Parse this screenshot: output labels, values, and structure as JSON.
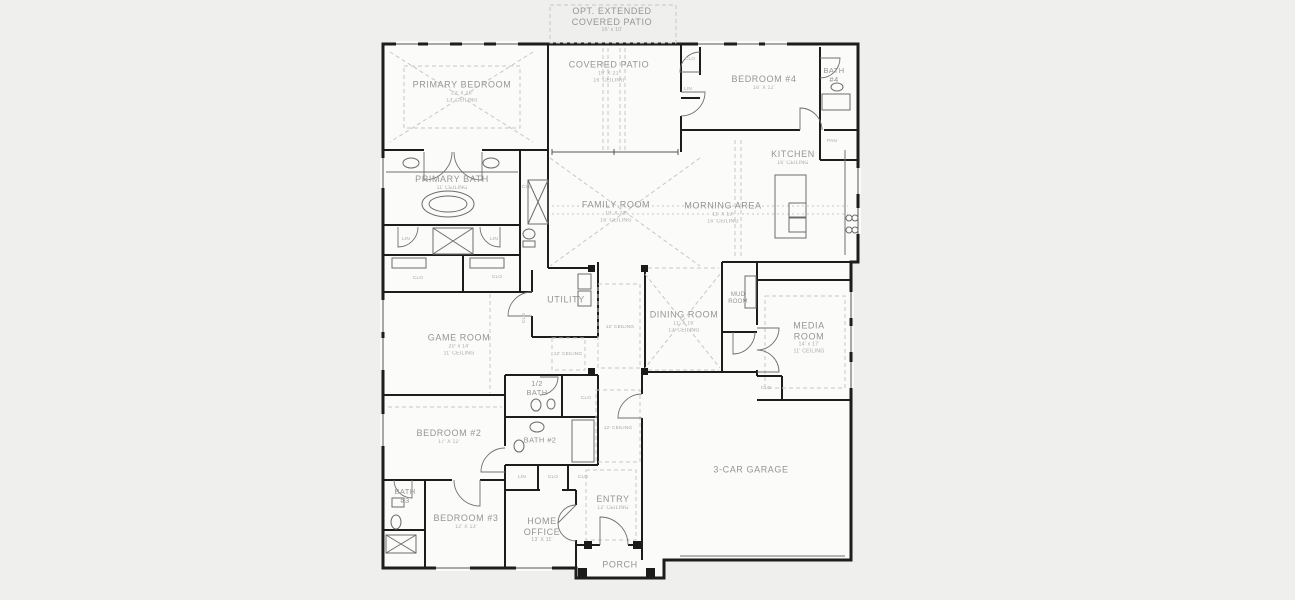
{
  "drawing_type": "residential floor plan",
  "colors": {
    "background": "#efefee",
    "paper": "#fbfbfa",
    "wall_ink": "#1d1d1d",
    "label_gray": "#959595",
    "dashed_gray": "#c7c7c7"
  },
  "rooms": [
    {
      "name": "OPT. EXTENDED COVERED PATIO",
      "dims": "16' x 10'",
      "ceiling": ""
    },
    {
      "name": "COVERED PATIO",
      "dims": "16' X 21'",
      "ceiling": "16' CEILING"
    },
    {
      "name": "PRIMARY BEDROOM",
      "dims": "22' X 16'",
      "ceiling": "13' CEILING"
    },
    {
      "name": "BEDROOM #4",
      "dims": "16' X 12'",
      "ceiling": ""
    },
    {
      "name": "BATH #4",
      "dims": "",
      "ceiling": ""
    },
    {
      "name": "KITCHEN",
      "dims": "",
      "ceiling": "16' CEILING"
    },
    {
      "name": "FAMILY ROOM",
      "dims": "19' X 21'",
      "ceiling": "16' CEILING"
    },
    {
      "name": "MORNING AREA",
      "dims": "11' X 13'",
      "ceiling": "16' CEILING"
    },
    {
      "name": "PRIMARY BATH",
      "dims": "",
      "ceiling": "11' CEILING"
    },
    {
      "name": "UTILITY",
      "dims": "",
      "ceiling": ""
    },
    {
      "name": "DINING ROOM",
      "dims": "11' X 16'",
      "ceiling": "13' CEILING"
    },
    {
      "name": "MUD ROOM",
      "dims": "",
      "ceiling": ""
    },
    {
      "name": "MEDIA ROOM",
      "dims": "14' x 17'",
      "ceiling": "11' CEILING"
    },
    {
      "name": "GAME ROOM",
      "dims": "20' x 14'",
      "ceiling": "11' CEILING"
    },
    {
      "name": "1/2 BATH",
      "dims": "",
      "ceiling": ""
    },
    {
      "name": "BEDROOM #2",
      "dims": "17' X 12'",
      "ceiling": ""
    },
    {
      "name": "BATH #2",
      "dims": "",
      "ceiling": ""
    },
    {
      "name": "3-CAR GARAGE",
      "dims": "",
      "ceiling": ""
    },
    {
      "name": "BATH #3",
      "dims": "",
      "ceiling": ""
    },
    {
      "name": "BEDROOM #3",
      "dims": "12' X 13'",
      "ceiling": ""
    },
    {
      "name": "HOME OFFICE",
      "dims": "13' X 11'",
      "ceiling": ""
    },
    {
      "name": "ENTRY",
      "dims": "",
      "ceiling": "12' CEILING"
    },
    {
      "name": "PORCH",
      "dims": "",
      "ceiling": ""
    }
  ],
  "small_labels": [
    {
      "text": "CLO"
    },
    {
      "text": "CLO"
    },
    {
      "text": "CLO"
    },
    {
      "text": "CLO"
    },
    {
      "text": "CLO"
    },
    {
      "text": "CLO"
    },
    {
      "text": "CLO"
    },
    {
      "text": "CLO"
    },
    {
      "text": "CLO"
    },
    {
      "text": "LIN"
    },
    {
      "text": "LIN"
    },
    {
      "text": "LIN"
    },
    {
      "text": "LIN"
    },
    {
      "text": "PAN"
    },
    {
      "text": "12' CEILING"
    },
    {
      "text": "12' CEILING"
    },
    {
      "text": "12' CEILING"
    }
  ]
}
